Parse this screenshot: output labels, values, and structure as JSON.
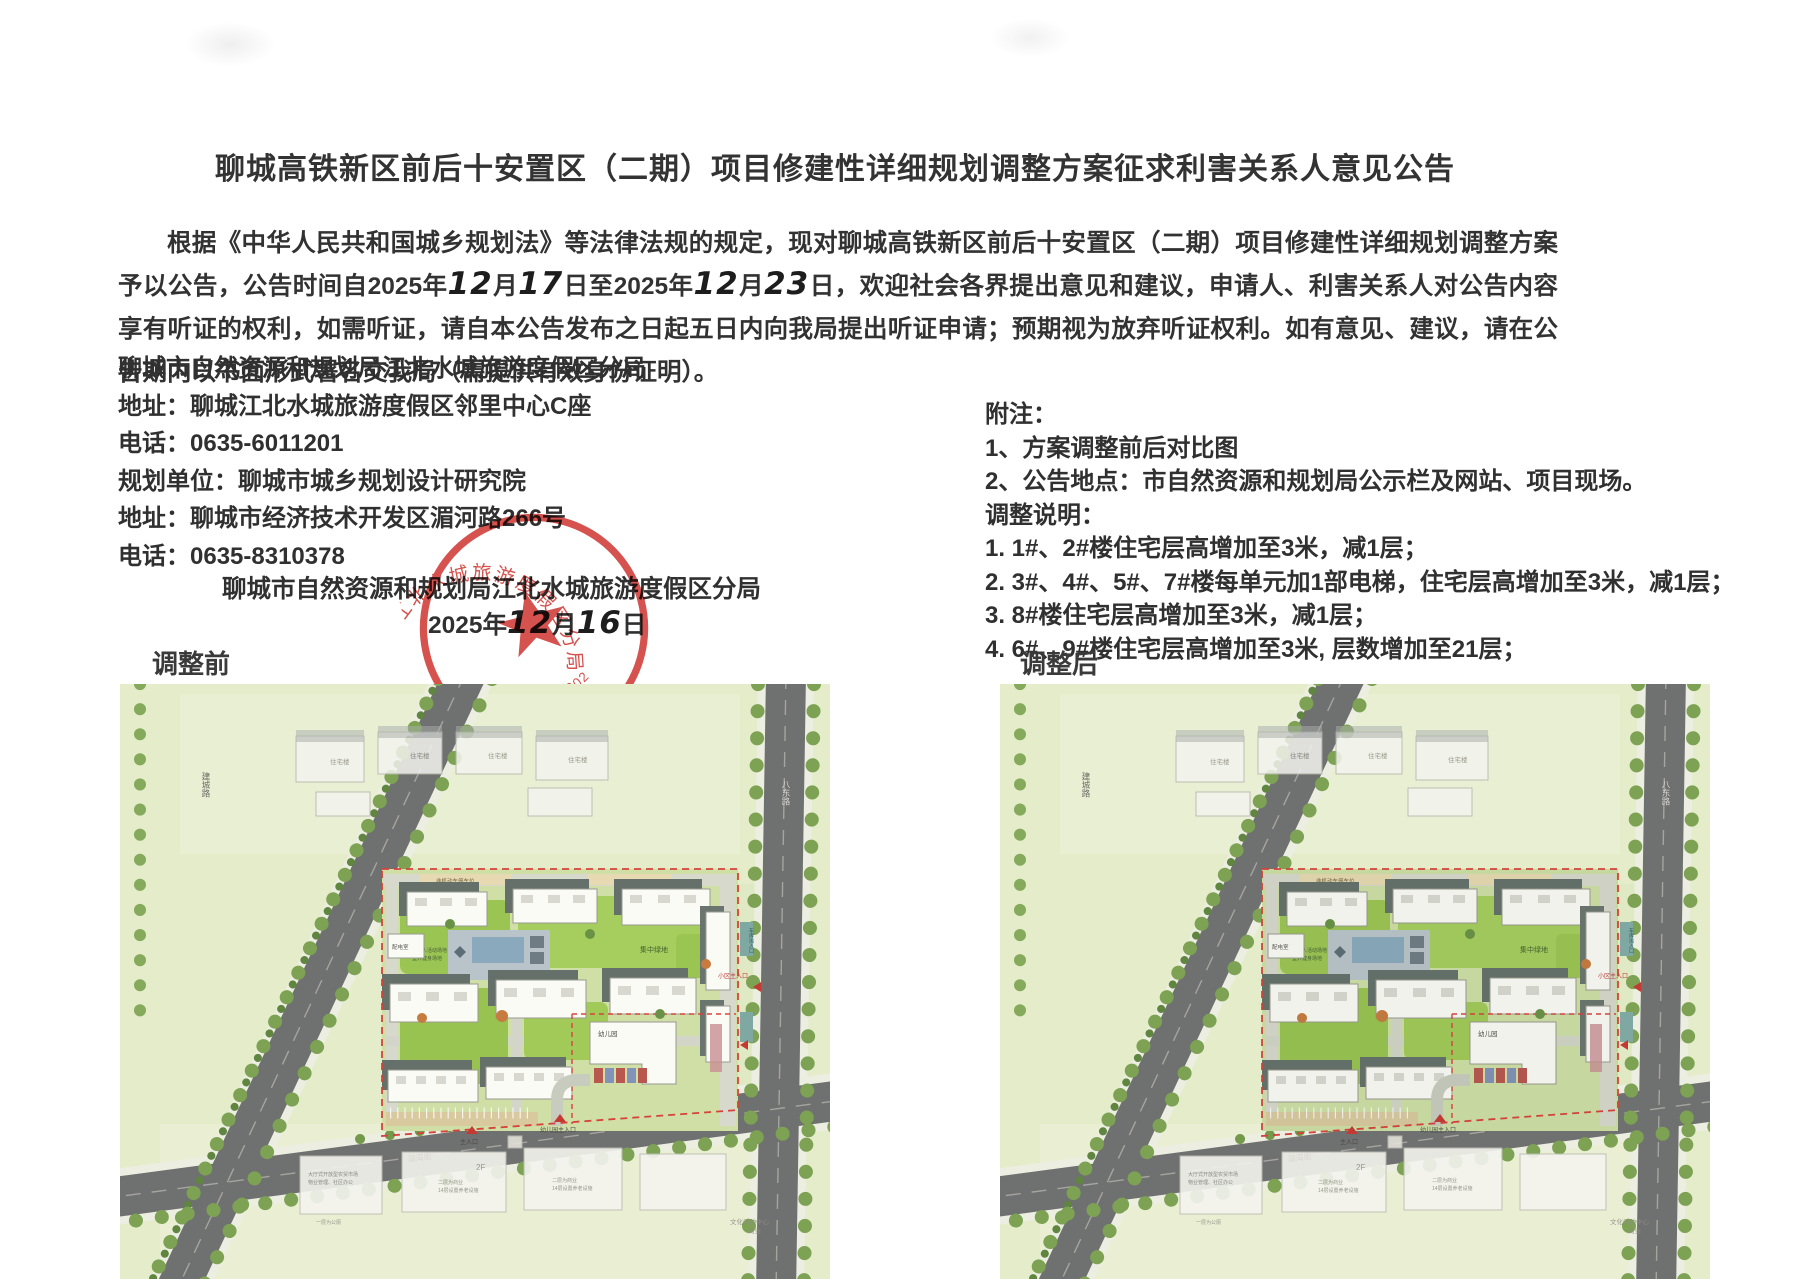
{
  "title": "聊城高铁新区前后十安置区（二期）项目修建性详细规划调整方案征求利害关系人意见公告",
  "paragraph": {
    "a": "根据《中华人民共和国城乡规划法》等法律法规的规定，现对聊城高铁新区前后十安置区（二期）项目修建性详细规划调整方案予以公告，公告时间自2025年",
    "m1": "12",
    "b": "月",
    "d1": "17",
    "c": "日至2025年",
    "m2": "12",
    "d": "月",
    "d2": "23",
    "e": "日，欢迎社会各界提出意见和建议，申请人、利害关系人对公告内容享有听证的权利，如需听证，请自本公告发布之日起五日内向我局提出听证申请；预期视为放弃听证权利。如有意见、建议，请在公告期内以书面形式署名交我局（需提供有效身份证明）。"
  },
  "contact": {
    "line1": "聊城市自然资源和规划局江北水城旅游度假区分局",
    "line2": "地址：聊城江北水城旅游度假区邻里中心C座",
    "line3": "电话：0635-6011201",
    "line4": "规划单位：聊城市城乡规划设计研究院",
    "line5": "地址：聊城市经济技术开发区湄河路266号",
    "line6": "电话：0635-8310378"
  },
  "signature": {
    "org": "聊城市自然资源和规划局江北水城旅游度假区分局",
    "year": "2025年",
    "month": "12",
    "month_suffix": "月",
    "day": "16",
    "day_suffix": "日"
  },
  "stamp": {
    "org": "聊城市自然资源和规划局江北水城旅游度假区分局",
    "number": "2019100200253",
    "color": "#cf3a35"
  },
  "notes": {
    "heading": "附注：",
    "item1": "1、方案调整前后对比图",
    "item2": "2、公告地点：市自然资源和规划局公示栏及网站、项目现场。",
    "adjust_heading": "调整说明：",
    "adjust1": "1. 1#、2#楼住宅层高增加至3米，减1层；",
    "adjust2": "2. 3#、4#、5#、7#楼每单元加1部电梯，住宅层高增加至3米，减1层；",
    "adjust3": "3. 8#楼住宅层高增加至3米，减1层；",
    "adjust4": "4. 6#、9#楼住宅层高增加至3米, 层数增加至21层；"
  },
  "maps": {
    "before_label": "调整前",
    "after_label": "调整后"
  },
  "map_labels": {
    "road_left": "建城路",
    "road_right": "八东路",
    "road_bottom": "湖湾街",
    "residential": "住宅楼",
    "bike_parking": "非机动车停车位",
    "central_green": "集中绿地",
    "elderly_area": "老年人活动场地",
    "fitness_area": "室外健身场地",
    "garage_entry": "地下车库入口",
    "substation": "配电室",
    "kindergarten": "幼儿园",
    "garage_gate": "车库出入口",
    "community_gate": "小区主入口",
    "main_gate": "主入口",
    "kg_gate": "幼儿园主入口",
    "market": "大厅式开放型农贸市场",
    "property": "物业管理、社区办公",
    "toilet": "一层为公厕",
    "commercial2": "二层为商业",
    "elder14": "14层设置养老设施",
    "culture": "文化活动中心",
    "business": "商业",
    "floors2": "2F"
  }
}
